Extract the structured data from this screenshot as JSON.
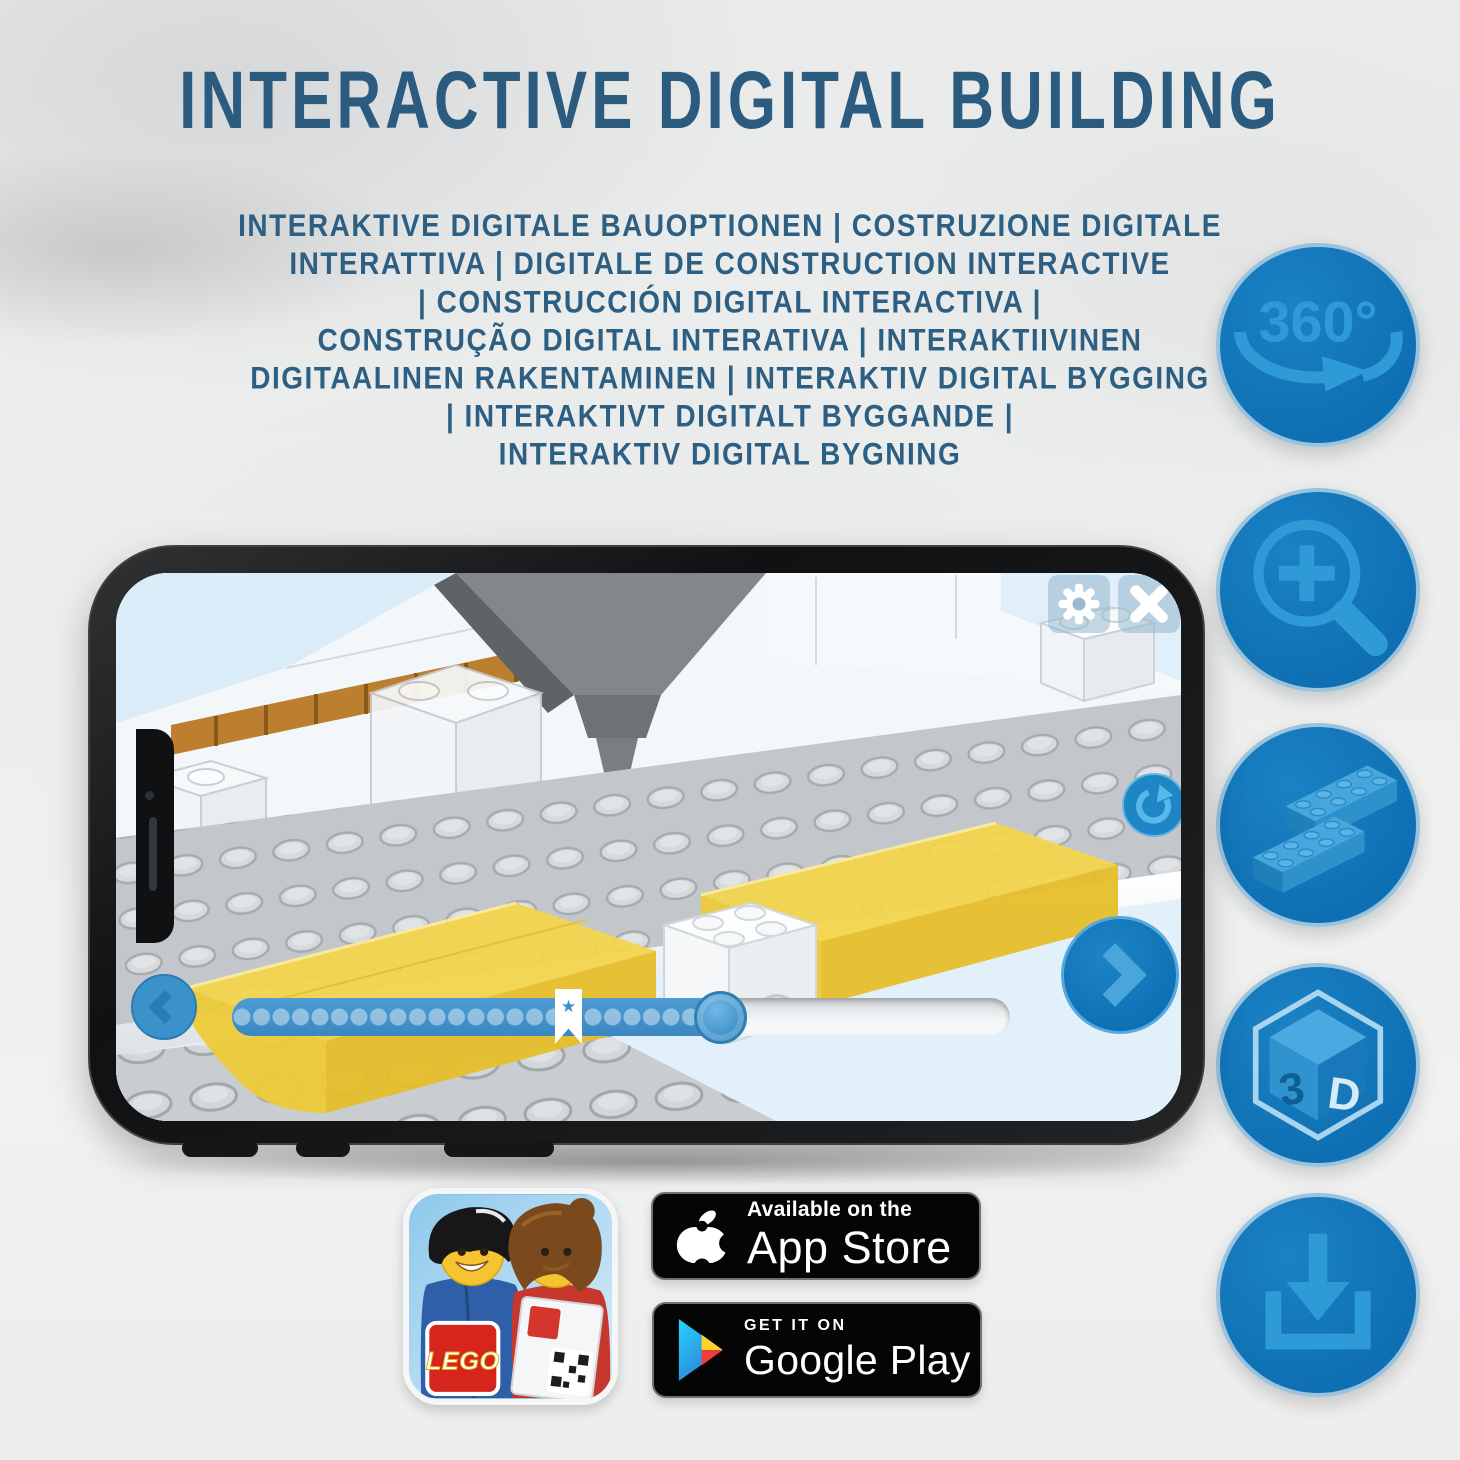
{
  "header": {
    "title": "INTERACTIVE DIGITAL BUILDING",
    "subtitle_lines": [
      "INTERAKTIVE DIGITALE BAUOPTIONEN | COSTRUZIONE DIGITALE",
      "INTERATTIVA | DIGITALE DE CONSTRUCTION INTERACTIVE",
      "| CONSTRUCCIÓN DIGITAL INTERACTIVA |",
      "CONSTRUÇÃO DIGITAL INTERATIVA | INTERAKTIIVINEN",
      "DIGITAALINEN RAKENTAMINEN | INTERAKTIV DIGITAL BYGGING",
      "| INTERAKTIVT DIGITALT BYGGANDE |",
      "INTERAKTIV DIGITAL BYGNING"
    ]
  },
  "features": [
    {
      "name": "360-rotation-icon",
      "label": "360°"
    },
    {
      "name": "zoom-in-icon",
      "label": ""
    },
    {
      "name": "lego-bricks-icon",
      "label": ""
    },
    {
      "name": "3d-cube-icon",
      "letters": [
        "3",
        "D"
      ]
    },
    {
      "name": "download-icon",
      "label": ""
    }
  ],
  "phone_app": {
    "control_icons": [
      "gear-icon",
      "close-icon",
      "rotate-icon",
      "back-chevron-icon",
      "next-chevron-icon"
    ],
    "progress": {
      "bookmark_star": "★"
    }
  },
  "badges": {
    "app_store": {
      "line1": "Available on the",
      "line2": "App Store"
    },
    "google_play": {
      "line1": "GET IT ON",
      "line2": "Google Play"
    }
  },
  "app_icon": {
    "logo_text": "LEGO"
  },
  "colors": {
    "title_blue": "#2b5c7f",
    "circle_blue": "#0f73b8",
    "icon_light_blue": "#2f9bd6",
    "brick_yellow": "#f2d147",
    "screen_sky": "#e9f4fb"
  }
}
